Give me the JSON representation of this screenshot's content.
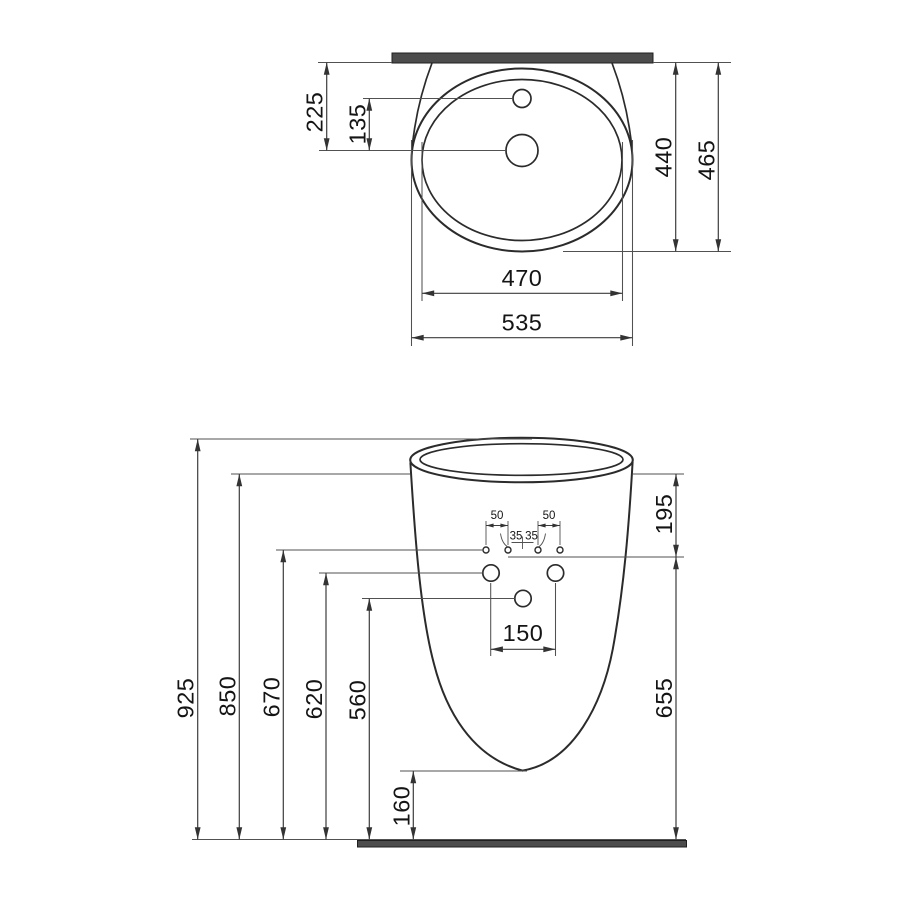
{
  "colors": {
    "background": "#ffffff",
    "outline": "#2b2b2b",
    "dimension_line": "#3d3d3d",
    "bar_fill": "#4c4c4c"
  },
  "top_view": {
    "dims": {
      "back_to_drain": "225",
      "tap_to_drain": "135",
      "inner_depth": "440",
      "total_depth": "465",
      "bowl_width": "470",
      "total_width": "535"
    }
  },
  "front_view": {
    "dims": {
      "total_height": "925",
      "rim_height": "850",
      "mount_holes_height": "670",
      "side_holes_height": "620",
      "center_hole_height": "560",
      "rim_to_mount_holes": "195",
      "mount_holes_to_floor": "655",
      "side_holes_spacing": "150",
      "base_clearance": "160",
      "mount_offset_left": "50",
      "mount_offset_right": "50",
      "mount_mid_left": "35",
      "mount_mid_right": "35"
    }
  }
}
